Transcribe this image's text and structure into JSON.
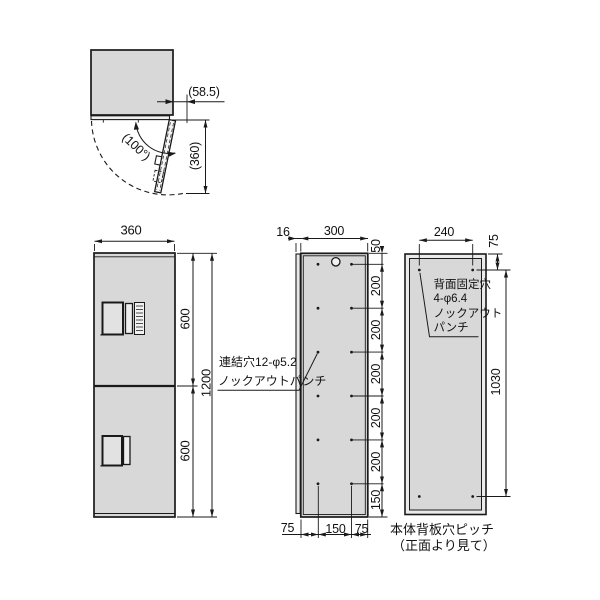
{
  "drawing": {
    "plan_view": {
      "protrusion_dim": "(58.5)",
      "open_angle_dim": "(100°)",
      "open_door_width_dim": "(360)"
    },
    "front_view": {
      "width_dim": "360",
      "upper_door_height_dim": "600",
      "lower_door_height_dim": "600",
      "total_height_dim": "1200"
    },
    "side_view": {
      "door_thickness_dim": "16",
      "depth_dim": "300",
      "top_hole_offset_dim": "50",
      "hole_pitch_dims": [
        "200",
        "200",
        "200",
        "200",
        "200"
      ],
      "bottom_hole_offset_dim": "150",
      "bottom_left_dim": "75",
      "bottom_center_dim": "150",
      "bottom_right_dim": "75",
      "hole_note_line1": "連結穴12-φ5.2",
      "hole_note_line2": "ノックアウトパンチ"
    },
    "back_view": {
      "hole_span_dim": "240",
      "top_offset_dim": "75",
      "vertical_pitch_dim": "1030",
      "note_line1": "背面固定穴",
      "note_line2": "4-φ6.4",
      "note_line3": "ノックアウト",
      "note_line4": "パンチ",
      "caption_line1": "本体背板穴ピッチ",
      "caption_line2": "（正面より見て）"
    },
    "colors": {
      "panel_fill": "#d8d8d8",
      "line": "#1a1a1a",
      "background": "#ffffff"
    }
  }
}
